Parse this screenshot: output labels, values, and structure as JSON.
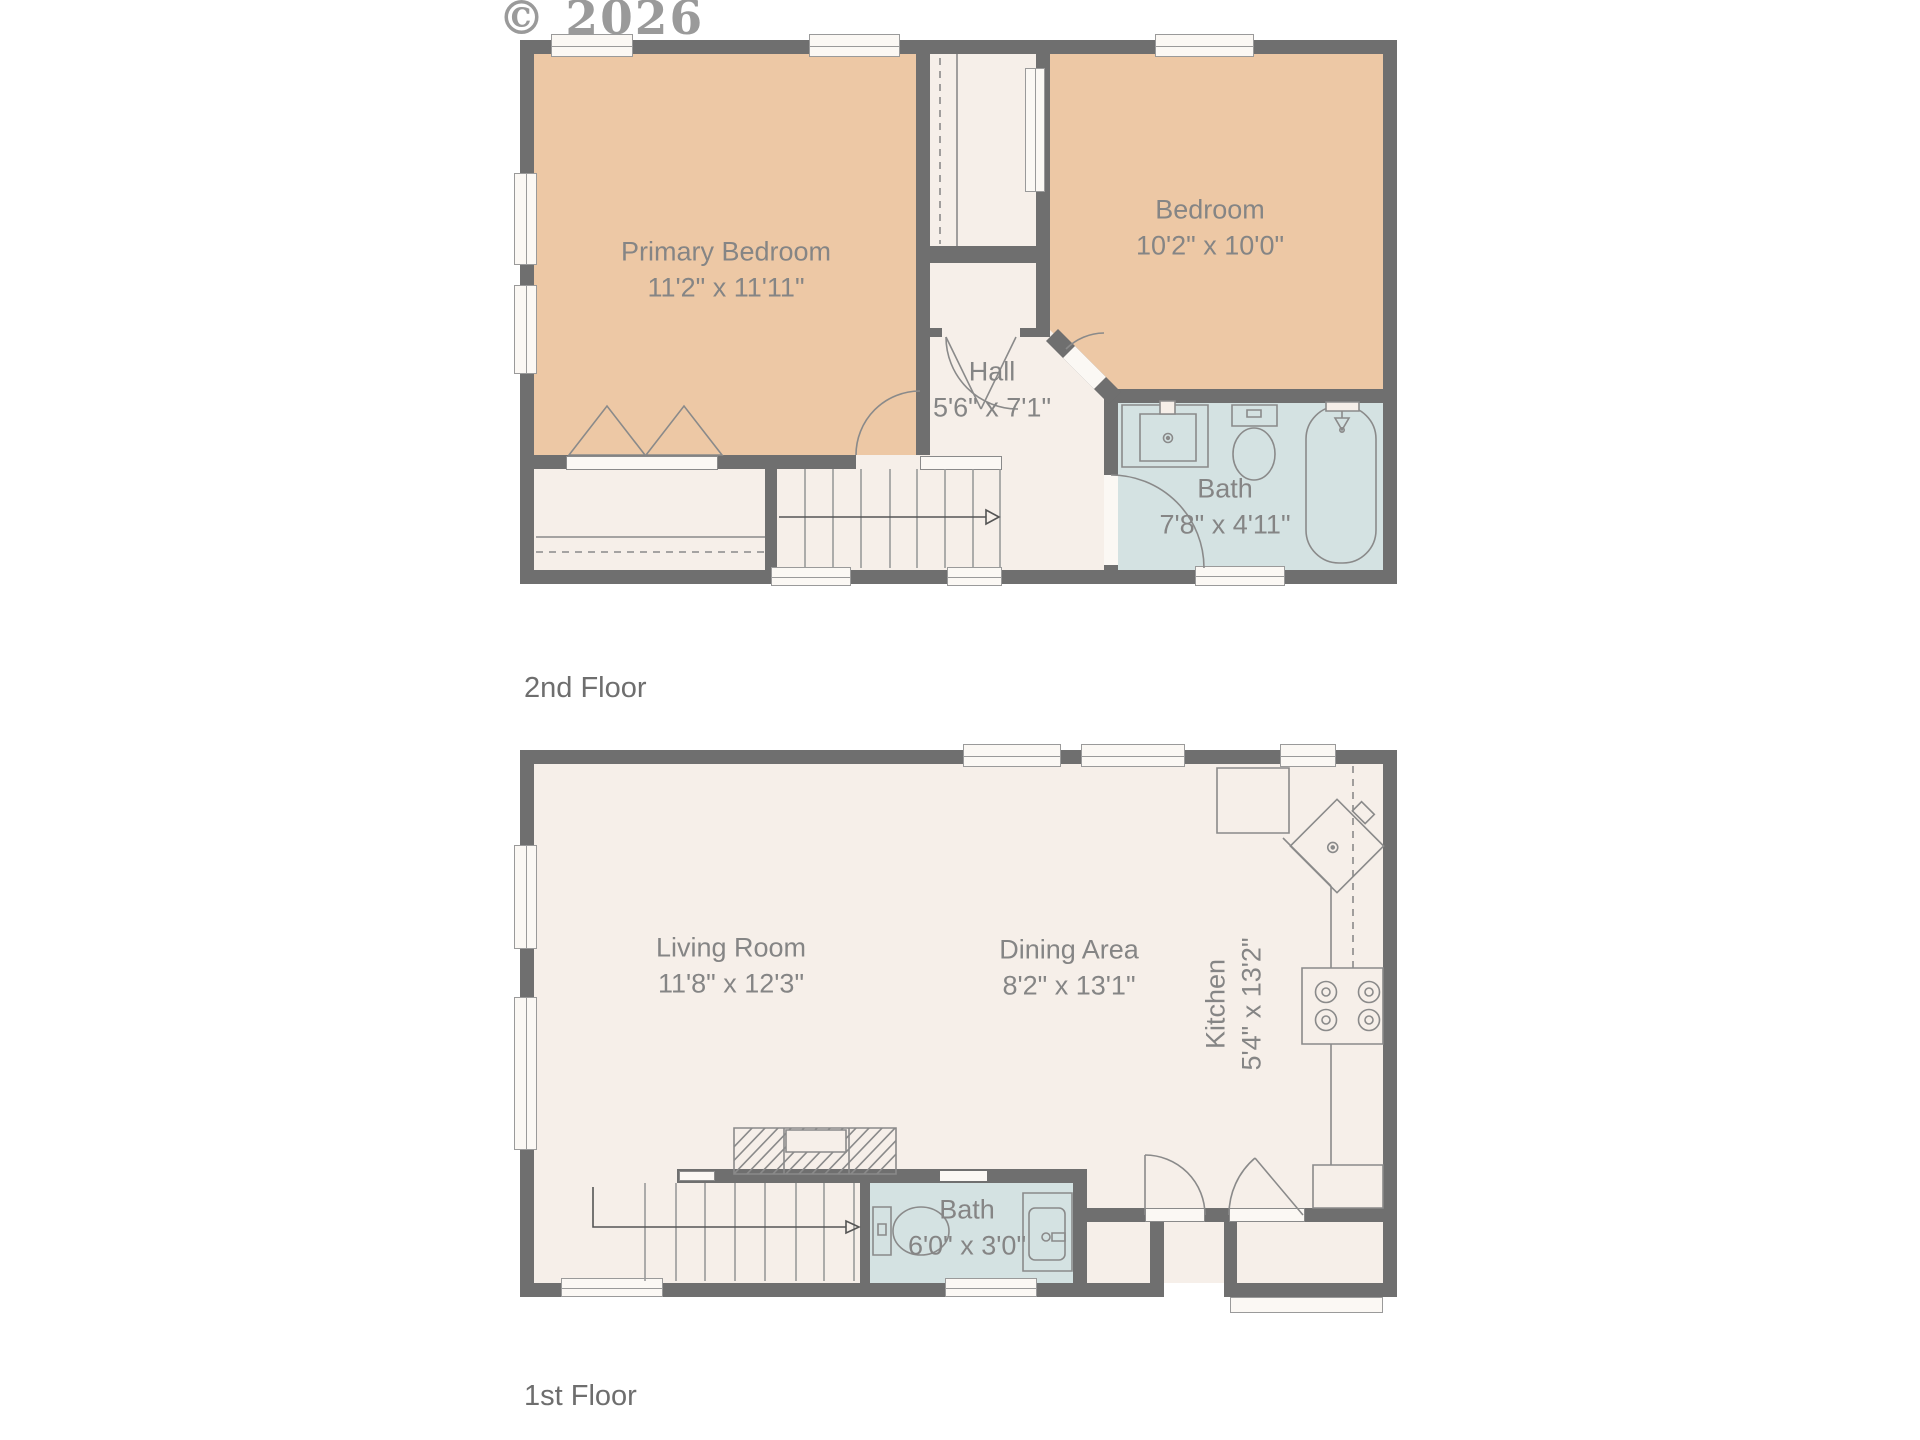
{
  "watermark": "© 2026",
  "colors": {
    "wall": "#6f6f6f",
    "floor": "#f6efe9",
    "bedroom_fill": "#edc8a5",
    "bath_fill": "#d4e2e2",
    "label_text": "#858585",
    "floor_label_text": "#6e6e6e",
    "line": "#8a8a8a"
  },
  "floors": [
    {
      "label": "2nd Floor",
      "rooms": [
        {
          "name": "Primary Bedroom",
          "dims": "11'2\" x 11'11\""
        },
        {
          "name": "Bedroom",
          "dims": "10'2\" x 10'0\""
        },
        {
          "name": "Hall",
          "dims": "5'6\" x 7'1\""
        },
        {
          "name": "Bath",
          "dims": "7'8\" x 4'11\""
        }
      ],
      "fixtures": [
        "vanity-sink",
        "toilet",
        "bathtub-with-shower",
        "staircase-up-arrow",
        "closet-rod-dashed",
        "bifold-closet-doors"
      ]
    },
    {
      "label": "1st Floor",
      "rooms": [
        {
          "name": "Living Room",
          "dims": "11'8\" x 12'3\""
        },
        {
          "name": "Dining Area",
          "dims": "8'2\" x 13'1\""
        },
        {
          "name": "Kitchen",
          "dims": "5'4\" x 13'2\""
        },
        {
          "name": "Bath",
          "dims": "6'0\" x 3'0\""
        }
      ],
      "fixtures": [
        "refrigerator",
        "corner-sink",
        "cooktop-4-burner",
        "dishwasher-dashed",
        "toilet",
        "shower-stall",
        "staircase-up-arrow",
        "stairs-overhead-hatch",
        "entry-doors"
      ]
    }
  ]
}
